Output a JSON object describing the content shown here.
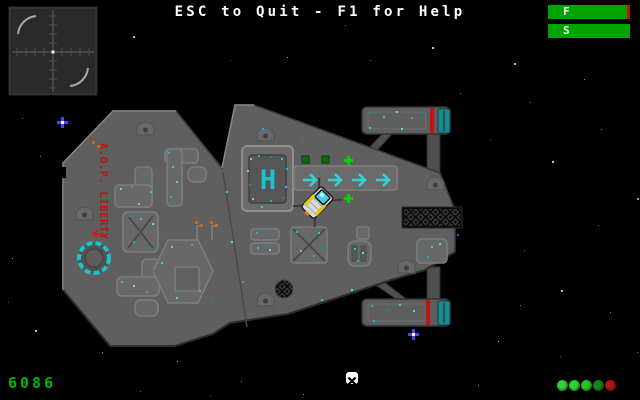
{
  "window": {
    "width": 640,
    "height": 400
  },
  "hud": {
    "help_text": "ESC to Quit - F1 for Help",
    "fuel_bar": {
      "label": "F",
      "fill": "96%",
      "bar_color": "#00a400",
      "warn_color": "#c41212"
    },
    "shield_bar": {
      "label": "S",
      "fill": "100%",
      "bar_color": "#00a400",
      "warn_color": "#00a400"
    },
    "score": "6086",
    "score_color": "#00b400",
    "status_lights": [
      "#2fd32f",
      "#2fd32f",
      "#28c428",
      "#128912",
      "#b31414"
    ],
    "waypoint_color": "#ffffff"
  },
  "radar": {
    "center_dot_color": "#f0f0f0",
    "line_color": "#505050",
    "arc_color": "#a8a8a8"
  },
  "station": {
    "name": "A.O.P. LIBERTY",
    "name_color": "#c01414",
    "helipad_letter": "H",
    "hull_color": "#5f5f5f",
    "accent_color": "#19c3cf",
    "arrow_color": "#2fd4d4",
    "marker_color": "#00d400",
    "marker_square_color": "#0b6e0b",
    "nacelle_stripe_color": "#c41212",
    "nacelle_cap_color": "#20888f"
  },
  "player_ship": {
    "hull_color": "#d9d9d9",
    "canopy_color": "#3ed2ea",
    "stripe_color": "#ddca1c",
    "engine_color": "#e07818"
  },
  "stars": [
    {
      "x": 133,
      "y": 36,
      "s": 2,
      "c": "#ffffff",
      "t": "dot"
    },
    {
      "x": 287,
      "y": 57,
      "s": 1,
      "c": "#cccccc",
      "t": "dot"
    },
    {
      "x": 345,
      "y": 25,
      "s": 1,
      "c": "#888888",
      "t": "dot"
    },
    {
      "x": 432,
      "y": 47,
      "s": 2,
      "c": "#ffffff",
      "t": "dot"
    },
    {
      "x": 514,
      "y": 63,
      "s": 2,
      "c": "#eeeeee",
      "t": "dot"
    },
    {
      "x": 584,
      "y": 79,
      "s": 1,
      "c": "#bbbbbb",
      "t": "dot"
    },
    {
      "x": 622,
      "y": 28,
      "s": 1,
      "c": "#ffffff",
      "t": "dot"
    },
    {
      "x": 530,
      "y": 102,
      "s": 1,
      "c": "#888888",
      "t": "dot"
    },
    {
      "x": 552,
      "y": 161,
      "s": 2,
      "c": "#ffffff",
      "t": "dot"
    },
    {
      "x": 601,
      "y": 129,
      "s": 1,
      "c": "#999999",
      "t": "dot"
    },
    {
      "x": 637,
      "y": 198,
      "s": 2,
      "c": "#cccccc",
      "t": "dot"
    },
    {
      "x": 524,
      "y": 250,
      "s": 1,
      "c": "#888888",
      "t": "dot"
    },
    {
      "x": 561,
      "y": 290,
      "s": 2,
      "c": "#ffffff",
      "t": "dot"
    },
    {
      "x": 610,
      "y": 312,
      "s": 1,
      "c": "#aaaaaa",
      "t": "dot"
    },
    {
      "x": 498,
      "y": 341,
      "s": 1,
      "c": "#eeeeee",
      "t": "dot"
    },
    {
      "x": 637,
      "y": 352,
      "s": 1,
      "c": "#999999",
      "t": "dot"
    },
    {
      "x": 478,
      "y": 385,
      "s": 1,
      "c": "#cccccc",
      "t": "dot"
    },
    {
      "x": 560,
      "y": 356,
      "s": 1,
      "c": "#777777",
      "t": "dot"
    },
    {
      "x": 40,
      "y": 156,
      "s": 1,
      "c": "#999999",
      "t": "dot"
    },
    {
      "x": 12,
      "y": 258,
      "s": 1,
      "c": "#cccccc",
      "t": "dot"
    },
    {
      "x": 35,
      "y": 330,
      "s": 2,
      "c": "#ffffff",
      "t": "dot"
    },
    {
      "x": 8,
      "y": 302,
      "s": 1,
      "c": "#777777",
      "t": "dot"
    },
    {
      "x": 22,
      "y": 118,
      "s": 1,
      "c": "#888888",
      "t": "dot"
    },
    {
      "x": 102,
      "y": 352,
      "s": 1,
      "c": "#cccccc",
      "t": "dot"
    },
    {
      "x": 177,
      "y": 361,
      "s": 1,
      "c": "#ffffff",
      "t": "dot"
    },
    {
      "x": 241,
      "y": 381,
      "s": 1,
      "c": "#999999",
      "t": "dot"
    },
    {
      "x": 303,
      "y": 394,
      "s": 1,
      "c": "#bbbbbb",
      "t": "dot"
    },
    {
      "x": 140,
      "y": 391,
      "s": 1,
      "c": "#888888",
      "t": "dot"
    },
    {
      "x": 210,
      "y": 396,
      "s": 1,
      "c": "#777777",
      "t": "dot"
    },
    {
      "x": 460,
      "y": 93,
      "s": 1,
      "c": "#999999",
      "t": "dot"
    },
    {
      "x": 230,
      "y": 60,
      "s": 1,
      "c": "#777777",
      "t": "dot"
    },
    {
      "x": 370,
      "y": 60,
      "s": 1,
      "c": "#888888",
      "t": "dot"
    },
    {
      "x": 490,
      "y": 140,
      "s": 1,
      "c": "#777777",
      "t": "dot"
    },
    {
      "x": 598,
      "y": 225,
      "s": 1,
      "c": "#888888",
      "t": "dot"
    },
    {
      "x": 520,
      "y": 305,
      "s": 1,
      "c": "#999999",
      "t": "dot"
    },
    {
      "x": 457,
      "y": 234,
      "s": 2,
      "c": "#5577ff",
      "t": "dot"
    },
    {
      "x": 57,
      "y": 117,
      "s": 11,
      "c": "#4646ff",
      "t": "cross"
    },
    {
      "x": 408,
      "y": 329,
      "s": 11,
      "c": "#4646ff",
      "t": "cross"
    }
  ],
  "speckles": [
    [
      250,
      158
    ],
    [
      258,
      155
    ],
    [
      270,
      156
    ],
    [
      281,
      158
    ],
    [
      247,
      170
    ],
    [
      286,
      168
    ],
    [
      249,
      184
    ],
    [
      285,
      186
    ],
    [
      252,
      198
    ],
    [
      270,
      200
    ],
    [
      282,
      197
    ],
    [
      261,
      206
    ],
    [
      120,
      188
    ],
    [
      131,
      186
    ],
    [
      145,
      175
    ],
    [
      150,
      191
    ],
    [
      138,
      203
    ],
    [
      168,
      152
    ],
    [
      180,
      155
    ],
    [
      172,
      166
    ],
    [
      176,
      181
    ],
    [
      170,
      196
    ],
    [
      128,
      215
    ],
    [
      140,
      218
    ],
    [
      152,
      223
    ],
    [
      133,
      241
    ],
    [
      148,
      247
    ],
    [
      121,
      281
    ],
    [
      133,
      285
    ],
    [
      146,
      291
    ],
    [
      152,
      270
    ],
    [
      161,
      262
    ],
    [
      171,
      246
    ],
    [
      191,
      244
    ],
    [
      205,
      258
    ],
    [
      199,
      290
    ],
    [
      176,
      297
    ],
    [
      256,
      232
    ],
    [
      266,
      234
    ],
    [
      257,
      247
    ],
    [
      269,
      249
    ],
    [
      296,
      231
    ],
    [
      306,
      236
    ],
    [
      318,
      232
    ],
    [
      300,
      250
    ],
    [
      313,
      255
    ],
    [
      321,
      247
    ],
    [
      354,
      248
    ],
    [
      362,
      252
    ],
    [
      357,
      260
    ],
    [
      422,
      243
    ],
    [
      431,
      246
    ],
    [
      439,
      243
    ],
    [
      427,
      256
    ],
    [
      370,
      112
    ],
    [
      383,
      116
    ],
    [
      396,
      111
    ],
    [
      411,
      117
    ],
    [
      421,
      112
    ],
    [
      369,
      127
    ],
    [
      401,
      128
    ],
    [
      371,
      305
    ],
    [
      386,
      309
    ],
    [
      399,
      304
    ],
    [
      413,
      310
    ],
    [
      373,
      320
    ],
    [
      406,
      319
    ],
    [
      226,
      191
    ],
    [
      231,
      241
    ],
    [
      242,
      281
    ],
    [
      212,
      300
    ],
    [
      321,
      299
    ],
    [
      351,
      289
    ],
    [
      262,
      128
    ],
    [
      301,
      141
    ]
  ]
}
